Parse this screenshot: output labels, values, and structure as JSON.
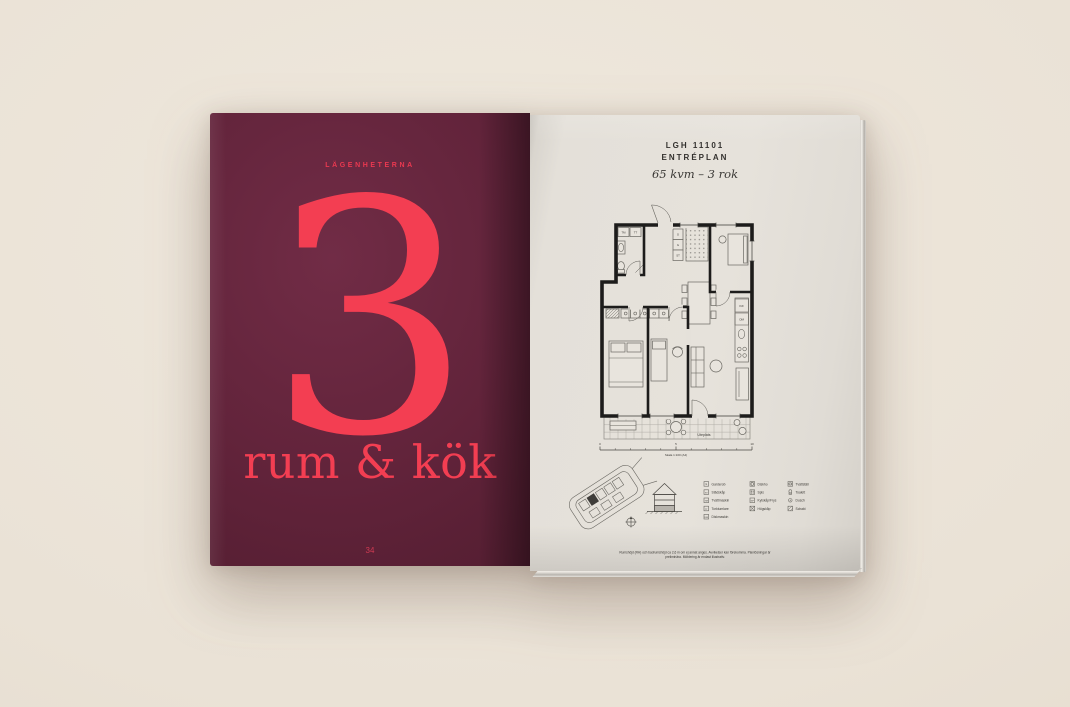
{
  "left_page": {
    "kicker": "LÄGENHETERNA",
    "big_number": "3",
    "subtitle": "rum & kök",
    "page_number": "34",
    "bg_color": "#5e2238",
    "accent_color": "#f33e52"
  },
  "right_page": {
    "header": {
      "line1": "LGH 11101",
      "line2": "ENTRÉPLAN",
      "line3": "65 kvm – 3 rok"
    },
    "plan_labels": {
      "tm": "TM",
      "tt": "TT",
      "g1": "G",
      "g2": "G",
      "st": "ST",
      "kf": "K/F",
      "dm": "DM",
      "terrace": "Uteplats"
    },
    "scalebar": {
      "start": "0",
      "mid": "5",
      "end": "10",
      "caption": "Skala 1:100 (A4)"
    },
    "legend": {
      "col1": [
        {
          "abbr": "G",
          "label": "Garderob"
        },
        {
          "abbr": "ST",
          "label": "Städskåp"
        },
        {
          "abbr": "TM",
          "label": "Tvättmaskin"
        },
        {
          "abbr": "TT",
          "label": "Torktumlare"
        },
        {
          "abbr": "DM",
          "label": "Diskmaskin"
        }
      ],
      "col2": [
        {
          "abbr": "",
          "label": "Diskho"
        },
        {
          "abbr": "",
          "label": "Spis"
        },
        {
          "abbr": "K/F",
          "label": "Kylskåp/Frys"
        },
        {
          "abbr": "",
          "label": "Högskåp"
        }
      ],
      "col3": [
        {
          "abbr": "",
          "label": "Tvättställ"
        },
        {
          "abbr": "",
          "label": "Toalett"
        },
        {
          "abbr": "",
          "label": "Dusch"
        },
        {
          "abbr": "",
          "label": "Schakt"
        }
      ]
    },
    "disclaimer": {
      "line1": "Rumshöjd (RH) och badrumshöjd ca 2,6 m om ej annat anges. Avvikelser kan förekomma. Planlösningar är",
      "line2": "preliminära. Möblering är endast illustrativ."
    }
  }
}
